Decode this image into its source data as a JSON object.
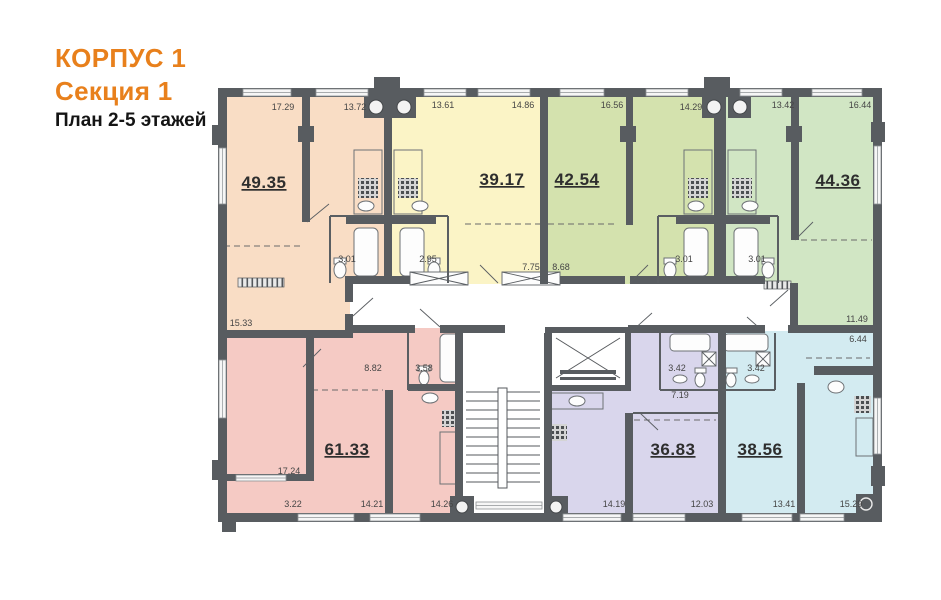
{
  "header": {
    "building": "КОРПУС 1",
    "section": "Секция 1",
    "plan": "План 2-5 этажей"
  },
  "colors": {
    "accent_orange": "#e8801c",
    "wall_gray": "#585c60",
    "text_dark": "#141414",
    "label_gray": "#454545"
  },
  "apartments": [
    {
      "name": "apt-49-35",
      "area": "49.35",
      "color": "#f9ddc5",
      "label": {
        "x": 264,
        "y": 188
      },
      "rooms": [
        {
          "v": "17.29",
          "x": 283,
          "y": 110
        },
        {
          "v": "13.72",
          "x": 355,
          "y": 110
        },
        {
          "v": "3.01",
          "x": 347,
          "y": 262
        },
        {
          "v": "15.33",
          "x": 241,
          "y": 326
        }
      ]
    },
    {
      "name": "apt-39-17",
      "area": "39.17",
      "color": "#fbf4c6",
      "label": {
        "x": 502,
        "y": 185
      },
      "rooms": [
        {
          "v": "13.61",
          "x": 443,
          "y": 108
        },
        {
          "v": "14.86",
          "x": 523,
          "y": 108
        },
        {
          "v": "2.95",
          "x": 428,
          "y": 262
        },
        {
          "v": "7.75",
          "x": 531,
          "y": 270
        }
      ]
    },
    {
      "name": "apt-42-54",
      "area": "42.54",
      "color": "#d4e2ae",
      "label": {
        "x": 577,
        "y": 185
      },
      "rooms": [
        {
          "v": "16.56",
          "x": 612,
          "y": 108
        },
        {
          "v": "14.29",
          "x": 691,
          "y": 110
        },
        {
          "v": "8.68",
          "x": 561,
          "y": 270
        },
        {
          "v": "3.01",
          "x": 684,
          "y": 262
        }
      ]
    },
    {
      "name": "apt-44-36",
      "area": "44.36",
      "color": "#d1e6c4",
      "label": {
        "x": 838,
        "y": 186
      },
      "rooms": [
        {
          "v": "13.42",
          "x": 783,
          "y": 108
        },
        {
          "v": "16.44",
          "x": 860,
          "y": 108
        },
        {
          "v": "3.01",
          "x": 757,
          "y": 262
        },
        {
          "v": "11.49",
          "x": 857,
          "y": 322
        }
      ]
    },
    {
      "name": "apt-61-33",
      "area": "61.33",
      "color": "#f5cac4",
      "label": {
        "x": 347,
        "y": 455
      },
      "rooms": [
        {
          "v": "17.24",
          "x": 289,
          "y": 474
        },
        {
          "v": "8.82",
          "x": 373,
          "y": 371
        },
        {
          "v": "3.58",
          "x": 424,
          "y": 371
        },
        {
          "v": "3.22",
          "x": 293,
          "y": 507
        },
        {
          "v": "14.21",
          "x": 372,
          "y": 507
        },
        {
          "v": "14.26",
          "x": 442,
          "y": 507
        }
      ]
    },
    {
      "name": "apt-36-83",
      "area": "36.83",
      "color": "#d9d6ec",
      "label": {
        "x": 673,
        "y": 455
      },
      "rooms": [
        {
          "v": "3.42",
          "x": 677,
          "y": 371
        },
        {
          "v": "7.19",
          "x": 680,
          "y": 398
        },
        {
          "v": "14.19",
          "x": 614,
          "y": 507
        },
        {
          "v": "12.03",
          "x": 702,
          "y": 507
        }
      ]
    },
    {
      "name": "apt-38-56",
      "area": "38.56",
      "color": "#d3ebf1",
      "label": {
        "x": 760,
        "y": 455
      },
      "rooms": [
        {
          "v": "3.42",
          "x": 756,
          "y": 371
        },
        {
          "v": "6.44",
          "x": 858,
          "y": 342
        },
        {
          "v": "13.41",
          "x": 784,
          "y": 507
        },
        {
          "v": "15.29",
          "x": 851,
          "y": 507
        }
      ]
    }
  ]
}
